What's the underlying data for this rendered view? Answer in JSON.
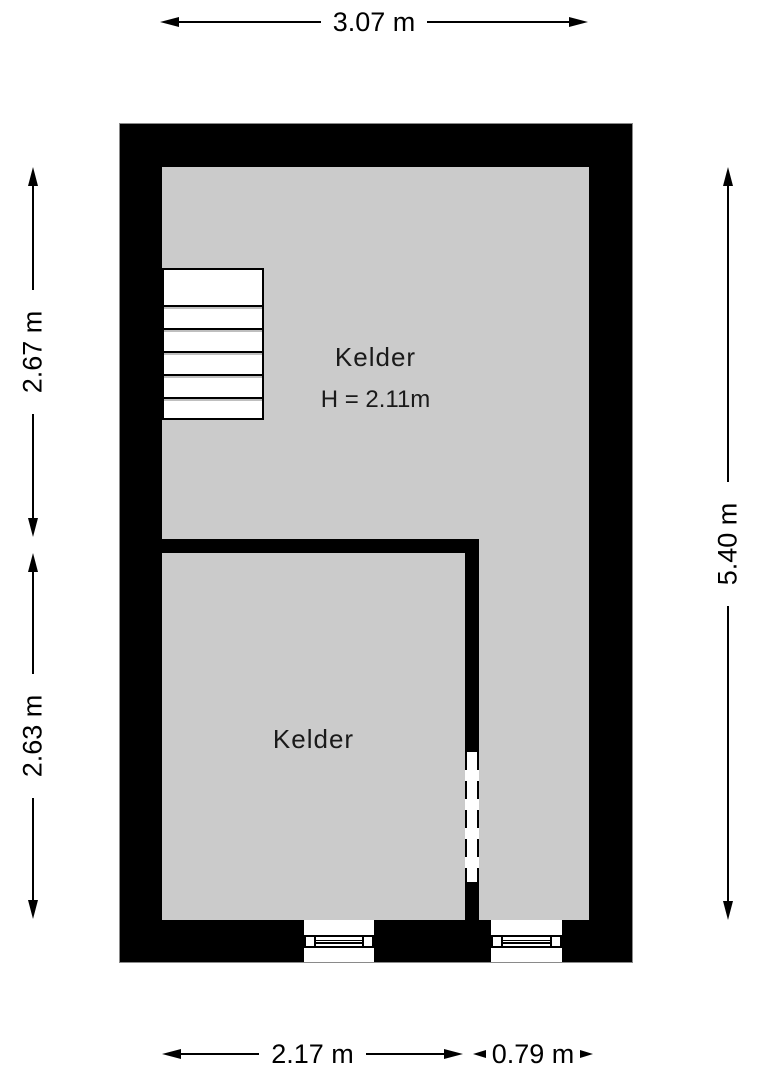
{
  "plan": {
    "title": "Kelder floor plan",
    "rooms": [
      {
        "label": "Kelder",
        "height_note": "H = 2.11m"
      },
      {
        "label": "Kelder"
      }
    ],
    "dimensions": {
      "top": "3.07 m",
      "left_upper": "2.67 m",
      "left_lower": "2.63 m",
      "right": "5.40 m",
      "bottom_left": "2.17 m",
      "bottom_right": "0.79 m"
    },
    "features": {
      "stairs_treads": 6,
      "windows": 2,
      "door_openings": 1
    },
    "colors": {
      "wall": "#000000",
      "floor": "#cbcbcb",
      "background": "#ffffff"
    }
  }
}
